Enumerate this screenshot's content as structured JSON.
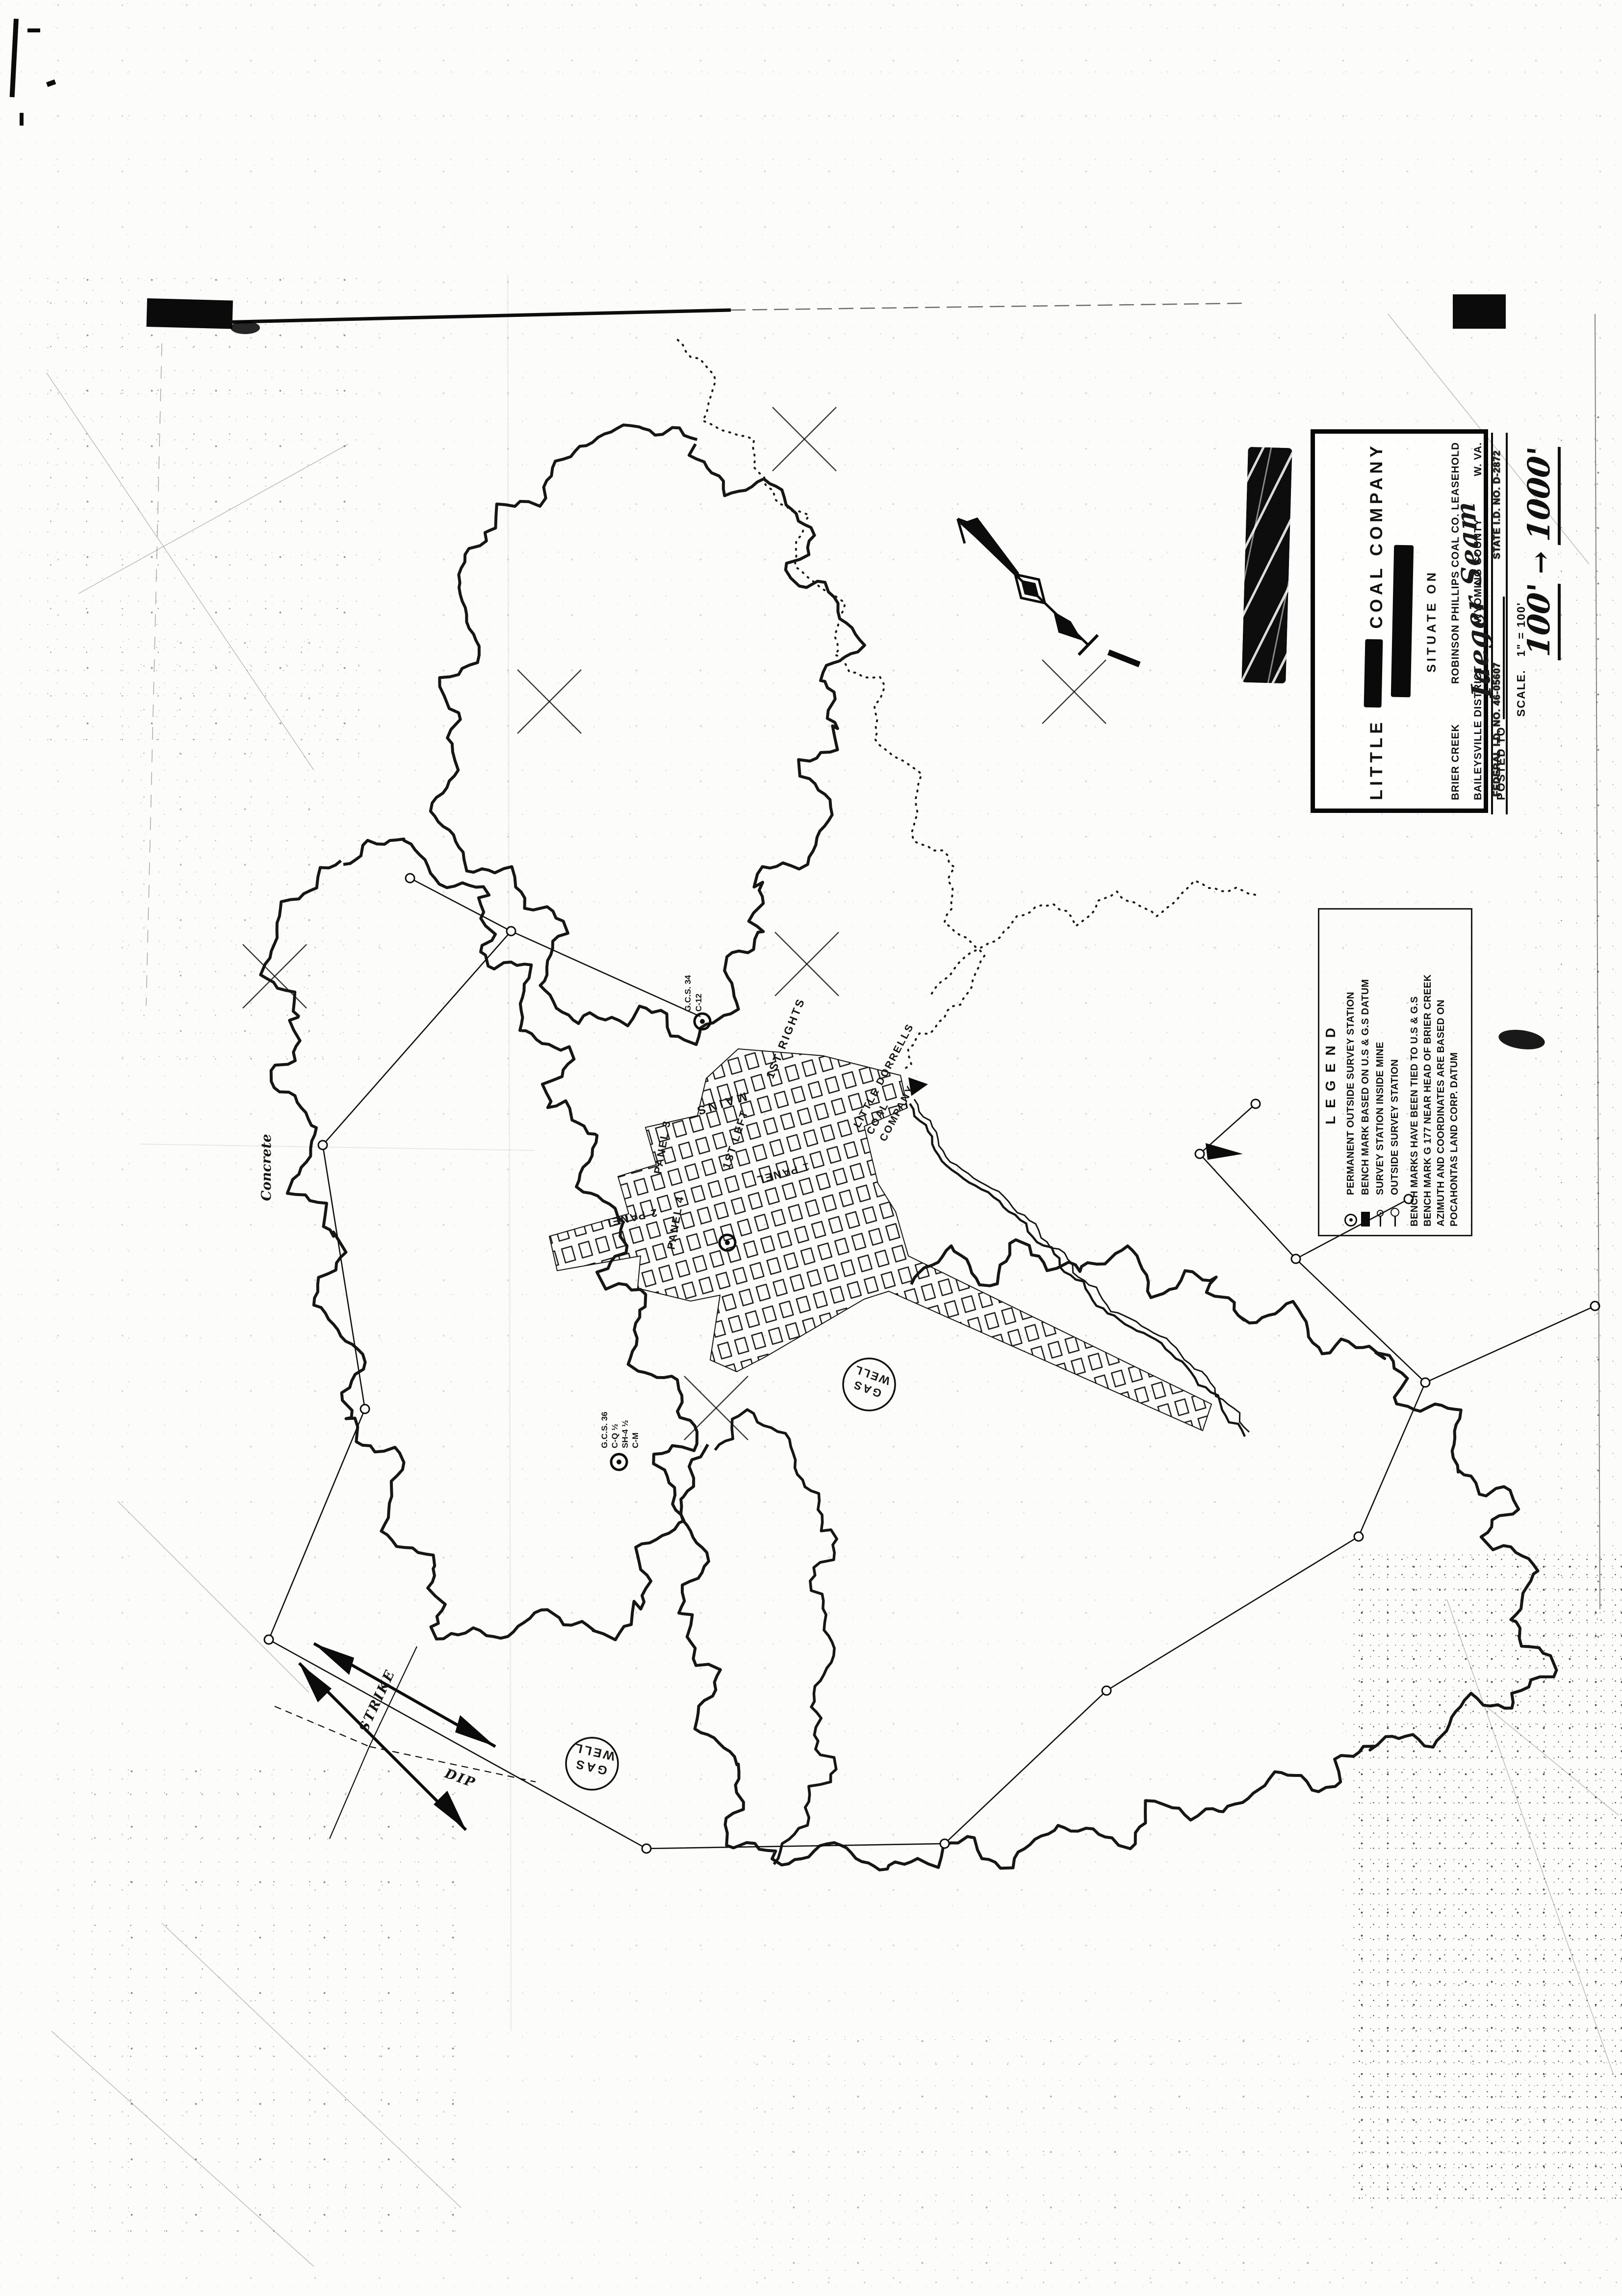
{
  "title_block": {
    "company_prefix": "LITTLE",
    "company_suffix": "COAL COMPANY",
    "situate_on": "SITUATE ON",
    "location_creek": "BRIER CREEK",
    "location_leasehold": "ROBINSON PHILLIPS COAL CO. LEASEHOLD",
    "district": "BAILEYSVILLE DISTRICT",
    "county": "WYOMING COUNTY",
    "state": "W. VA.",
    "posted_to_label": "POSTED TO",
    "scale_prefix": "SCALE.",
    "scale_value": "1\" = 100'",
    "seam_handwritten": "Iaeger Seam",
    "federal_id": "FEDERAL I.D. NO. 46-05607",
    "state_id": "STATE I.D. NO. D-2872"
  },
  "scale_note": {
    "from": "100'",
    "arrow": "→",
    "to": "1000'"
  },
  "legend": {
    "title": "LEGEND",
    "items": [
      {
        "symbol": "bullseye-icon",
        "label": "PERMANENT OUTSIDE SURVEY STATION"
      },
      {
        "symbol": "bench-mark-icon",
        "label": "BENCH MARK BASED ON U.S & G.S DATUM"
      },
      {
        "symbol": "inside-station-icon",
        "label": "SURVEY STATION INSIDE MINE"
      },
      {
        "symbol": "outside-station-icon",
        "label": "OUTSIDE SURVEY STATION"
      }
    ],
    "notes": [
      "BENCH MARKS HAVE BEEN TIED TO U.S & G.S",
      "BENCH MARK G 177 NEAR HEAD OF BRIER CREEK",
      "AZIMUTH AND COORDINATES ARE BASED ON",
      "POCAHONTAS LAND CORP. DATUM"
    ]
  },
  "annotations": {
    "gas_well": {
      "line1": "GAS",
      "line2": "WELL"
    },
    "strike_label": "STRIKE",
    "dip_label": "DIP",
    "concrete_label": "Concrete",
    "portal_label": {
      "line1": "LITTLE DORRELLS",
      "line2": "COAL",
      "line3": "COMPANY"
    },
    "station_1": {
      "l1": "G.C.S. 34",
      "l2": "C-12"
    },
    "station_2": {
      "l1": "G.C.S. 36",
      "l2": "C-Q ½",
      "l3": "SH-4 ½",
      "l4": "C-M"
    }
  },
  "mine_labels": [
    {
      "text": "MAINS"
    },
    {
      "text": "1ST RIGHTS"
    },
    {
      "text": "1ST LEFT"
    },
    {
      "text": "PANEL 3"
    },
    {
      "text": "2 PANEL"
    },
    {
      "text": "PANEL 4"
    },
    {
      "text": "1 PANEL"
    }
  ],
  "colors": {
    "ink": "#141414",
    "paper": "#fcfcfa"
  },
  "map_geometry": {
    "blobs": [
      {
        "amp": 20,
        "lam": 140,
        "w": 6,
        "pts": [
          [
            1418,
            905
          ],
          [
            1300,
            862
          ],
          [
            1180,
            908
          ],
          [
            1088,
            1012
          ],
          [
            980,
            1082
          ],
          [
            930,
            1200
          ],
          [
            978,
            1318
          ],
          [
            900,
            1420
          ],
          [
            938,
            1540
          ],
          [
            880,
            1652
          ],
          [
            958,
            1760
          ],
          [
            1058,
            1802
          ],
          [
            1148,
            1898
          ],
          [
            1100,
            2010
          ],
          [
            1180,
            2088
          ],
          [
            1300,
            2058
          ],
          [
            1412,
            2118
          ],
          [
            1500,
            2058
          ],
          [
            1482,
            1950
          ],
          [
            1560,
            1898
          ],
          [
            1532,
            1790
          ],
          [
            1640,
            1758
          ],
          [
            1698,
            1660
          ],
          [
            1640,
            1560
          ],
          [
            1718,
            1480
          ],
          [
            1668,
            1380
          ],
          [
            1758,
            1318
          ],
          [
            1700,
            1218
          ],
          [
            1620,
            1180
          ],
          [
            1648,
            1060
          ],
          [
            1558,
            978
          ],
          [
            1478,
            1010
          ],
          [
            1418,
            905
          ]
        ]
      },
      {
        "amp": 19,
        "lam": 130,
        "w": 6,
        "pts": [
          [
            700,
            1762
          ],
          [
            580,
            1840
          ],
          [
            540,
            1980
          ],
          [
            620,
            2080
          ],
          [
            558,
            2200
          ],
          [
            648,
            2300
          ],
          [
            598,
            2420
          ],
          [
            700,
            2520
          ],
          [
            640,
            2660
          ],
          [
            738,
            2760
          ],
          [
            700,
            2900
          ],
          [
            820,
            2980
          ],
          [
            778,
            3120
          ],
          [
            898,
            3200
          ],
          [
            878,
            3320
          ],
          [
            1020,
            3338
          ],
          [
            1118,
            3278
          ],
          [
            1218,
            3338
          ],
          [
            1318,
            3278
          ],
          [
            1300,
            3160
          ],
          [
            1398,
            3098
          ],
          [
            1338,
            2990
          ],
          [
            1418,
            2920
          ],
          [
            1378,
            2820
          ],
          [
            1278,
            2780
          ],
          [
            1318,
            2660
          ],
          [
            1238,
            2600
          ],
          [
            1278,
            2480
          ],
          [
            1178,
            2420
          ],
          [
            1218,
            2300
          ],
          [
            1118,
            2258
          ],
          [
            1158,
            2140
          ],
          [
            1058,
            2100
          ],
          [
            1078,
            1980
          ],
          [
            978,
            1940
          ],
          [
            998,
            1820
          ],
          [
            898,
            1800
          ],
          [
            818,
            1700
          ],
          [
            700,
            1762
          ]
        ]
      },
      {
        "amp": 22,
        "lam": 150,
        "w": 6,
        "pts": [
          [
            1452,
            2950
          ],
          [
            1380,
            3060
          ],
          [
            1440,
            3180
          ],
          [
            1378,
            3300
          ],
          [
            1458,
            3400
          ],
          [
            1420,
            3520
          ],
          [
            1518,
            3600
          ],
          [
            1478,
            3720
          ],
          [
            1578,
            3800
          ],
          [
            1700,
            3758
          ],
          [
            1820,
            3818
          ],
          [
            1938,
            3758
          ],
          [
            2058,
            3798
          ],
          [
            2158,
            3718
          ],
          [
            2278,
            3758
          ],
          [
            2378,
            3678
          ],
          [
            2498,
            3698
          ],
          [
            2598,
            3618
          ],
          [
            2718,
            3638
          ],
          [
            2798,
            3538
          ],
          [
            2918,
            3558
          ],
          [
            2998,
            3458
          ],
          [
            3098,
            3478
          ],
          [
            3158,
            3378
          ],
          [
            3078,
            3300
          ],
          [
            3138,
            3198
          ],
          [
            3038,
            3140
          ],
          [
            3078,
            3040
          ],
          [
            2958,
            2998
          ],
          [
            2978,
            2878
          ],
          [
            2858,
            2858
          ],
          [
            2818,
            2738
          ],
          [
            2698,
            2758
          ],
          [
            2638,
            2658
          ],
          [
            2518,
            2698
          ],
          [
            2478,
            2598
          ],
          [
            2358,
            2638
          ],
          [
            2298,
            2538
          ],
          [
            2198,
            2598
          ],
          [
            2098,
            2538
          ],
          [
            1998,
            2618
          ],
          [
            1938,
            2538
          ],
          [
            1858,
            2618
          ]
        ]
      },
      {
        "amp": 17,
        "lam": 120,
        "w": 5.5,
        "pts": [
          [
            1452,
            2950
          ],
          [
            1520,
            2880
          ],
          [
            1600,
            2922
          ],
          [
            1642,
            3030
          ],
          [
            1700,
            3120
          ],
          [
            1660,
            3240
          ],
          [
            1702,
            3360
          ],
          [
            1652,
            3480
          ],
          [
            1692,
            3600
          ],
          [
            1642,
            3700
          ],
          [
            1578,
            3800
          ]
        ]
      }
    ],
    "creeks_dotted": [
      [
        [
          1385,
          690
        ],
        [
          1462,
          778
        ],
        [
          1432,
          858
        ],
        [
          1532,
          898
        ],
        [
          1560,
          1000
        ],
        [
          1640,
          1048
        ],
        [
          1620,
          1158
        ],
        [
          1720,
          1228
        ],
        [
          1700,
          1338
        ],
        [
          1800,
          1398
        ],
        [
          1780,
          1508
        ],
        [
          1878,
          1578
        ],
        [
          1858,
          1698
        ],
        [
          1948,
          1768
        ],
        [
          1928,
          1878
        ],
        [
          2008,
          1948
        ],
        [
          1958,
          2048
        ],
        [
          1878,
          2108
        ],
        [
          1845,
          2178
        ]
      ],
      [
        [
          2558,
          1828
        ],
        [
          2438,
          1798
        ],
        [
          2358,
          1868
        ],
        [
          2278,
          1818
        ],
        [
          2198,
          1878
        ],
        [
          2118,
          1838
        ],
        [
          2038,
          1908
        ],
        [
          1958,
          1958
        ],
        [
          1898,
          2028
        ]
      ]
    ],
    "creeks_double": [
      [
        [
          1858,
          2248
        ],
        [
          1928,
          2378
        ],
        [
          2038,
          2448
        ],
        [
          2138,
          2548
        ],
        [
          2258,
          2678
        ],
        [
          2368,
          2738
        ],
        [
          2468,
          2838
        ],
        [
          2538,
          2928
        ]
      ]
    ],
    "traverse": [
      [
        [
          836,
          1790
        ],
        [
          1042,
          1898
        ],
        [
          658,
          2334
        ],
        [
          744,
          2872
        ],
        [
          548,
          3342
        ],
        [
          1318,
          3768
        ],
        [
          1926,
          3758
        ],
        [
          2256,
          3446
        ],
        [
          2770,
          3132
        ],
        [
          2906,
          2818
        ],
        [
          2642,
          2566
        ],
        [
          2446,
          2352
        ]
      ],
      [
        [
          2906,
          2818
        ],
        [
          3252,
          2662
        ]
      ],
      [
        [
          2642,
          2566
        ],
        [
          2872,
          2444
        ]
      ],
      [
        [
          1042,
          1898
        ],
        [
          1428,
          2072
        ]
      ],
      [
        [
          2446,
          2352
        ],
        [
          2560,
          2250
        ]
      ]
    ],
    "stations": [
      [
        836,
        1790
      ],
      [
        1042,
        1898
      ],
      [
        658,
        2334
      ],
      [
        744,
        2872
      ],
      [
        548,
        3342
      ],
      [
        1318,
        3768
      ],
      [
        1926,
        3758
      ],
      [
        2256,
        3446
      ],
      [
        2770,
        3132
      ],
      [
        2906,
        2818
      ],
      [
        2642,
        2566
      ],
      [
        2446,
        2352
      ],
      [
        3252,
        2662
      ],
      [
        2872,
        2444
      ],
      [
        2560,
        2250
      ]
    ],
    "bullseyes": [
      [
        1432,
        2082
      ],
      [
        1262,
        2980
      ],
      [
        1483,
        2533
      ]
    ],
    "x_marks": [
      [
        1120,
        1430
      ],
      [
        1640,
        895
      ],
      [
        1645,
        1965
      ],
      [
        560,
        1990
      ],
      [
        1460,
        2870
      ],
      [
        2190,
        1410
      ]
    ],
    "gas_wells": [
      [
        1207,
        3595
      ],
      [
        1772,
        2822
      ]
    ],
    "workings_outline": [
      [
        1505,
        2138
      ],
      [
        1678,
        2152
      ],
      [
        1836,
        2192
      ],
      [
        1850,
        2258
      ],
      [
        1762,
        2296
      ],
      [
        1790,
        2412
      ],
      [
        1826,
        2470
      ],
      [
        1852,
        2560
      ],
      [
        2470,
        2862
      ],
      [
        2452,
        2916
      ],
      [
        1812,
        2632
      ],
      [
        1762,
        2648
      ],
      [
        1560,
        2766
      ],
      [
        1502,
        2796
      ],
      [
        1448,
        2772
      ],
      [
        1468,
        2640
      ],
      [
        1408,
        2652
      ],
      [
        1300,
        2626
      ],
      [
        1306,
        2560
      ],
      [
        1136,
        2590
      ],
      [
        1120,
        2520
      ],
      [
        1282,
        2474
      ],
      [
        1260,
        2398
      ],
      [
        1338,
        2374
      ],
      [
        1316,
        2298
      ],
      [
        1422,
        2274
      ],
      [
        1440,
        2198
      ]
    ],
    "heavy_lines": [
      [
        640,
        3350,
        1010,
        3560
      ],
      [
        610,
        3390,
        950,
        3730
      ]
    ],
    "thin_lines": [
      [
        850,
        3356,
        753,
        3560
      ],
      [
        753,
        3560,
        672,
        3748
      ]
    ],
    "dashed_lines": [
      [
        560,
        3478,
        753,
        3560
      ],
      [
        753,
        3560,
        1092,
        3632
      ]
    ],
    "solid_marks": [
      [
        [
          1852,
          2196
        ],
        [
          1892,
          2210
        ],
        [
          1858,
          2234
        ]
      ],
      [
        [
          2458,
          2330
        ],
        [
          2534,
          2352
        ],
        [
          2462,
          2364
        ]
      ],
      [
        [
          640,
          3350
        ],
        [
          722,
          3379
        ],
        [
          712,
          3414
        ]
      ],
      [
        [
          1010,
          3560
        ],
        [
          928,
          3531
        ],
        [
          938,
          3496
        ]
      ],
      [
        [
          610,
          3390
        ],
        [
          676,
          3442
        ],
        [
          648,
          3470
        ]
      ],
      [
        [
          950,
          3730
        ],
        [
          884,
          3678
        ],
        [
          912,
          3650
        ]
      ]
    ],
    "scratches": [
      [
        95,
        760,
        640,
        1570
      ],
      [
        160,
        1210,
        710,
        905
      ],
      [
        240,
        3060,
        630,
        3450
      ],
      [
        2950,
        3260,
        3290,
        4230
      ],
      [
        330,
        3920,
        940,
        4500
      ],
      [
        2830,
        640,
        3240,
        1150
      ],
      [
        105,
        4140,
        640,
        4620
      ],
      [
        3020,
        3470,
        3300,
        3700
      ]
    ]
  }
}
